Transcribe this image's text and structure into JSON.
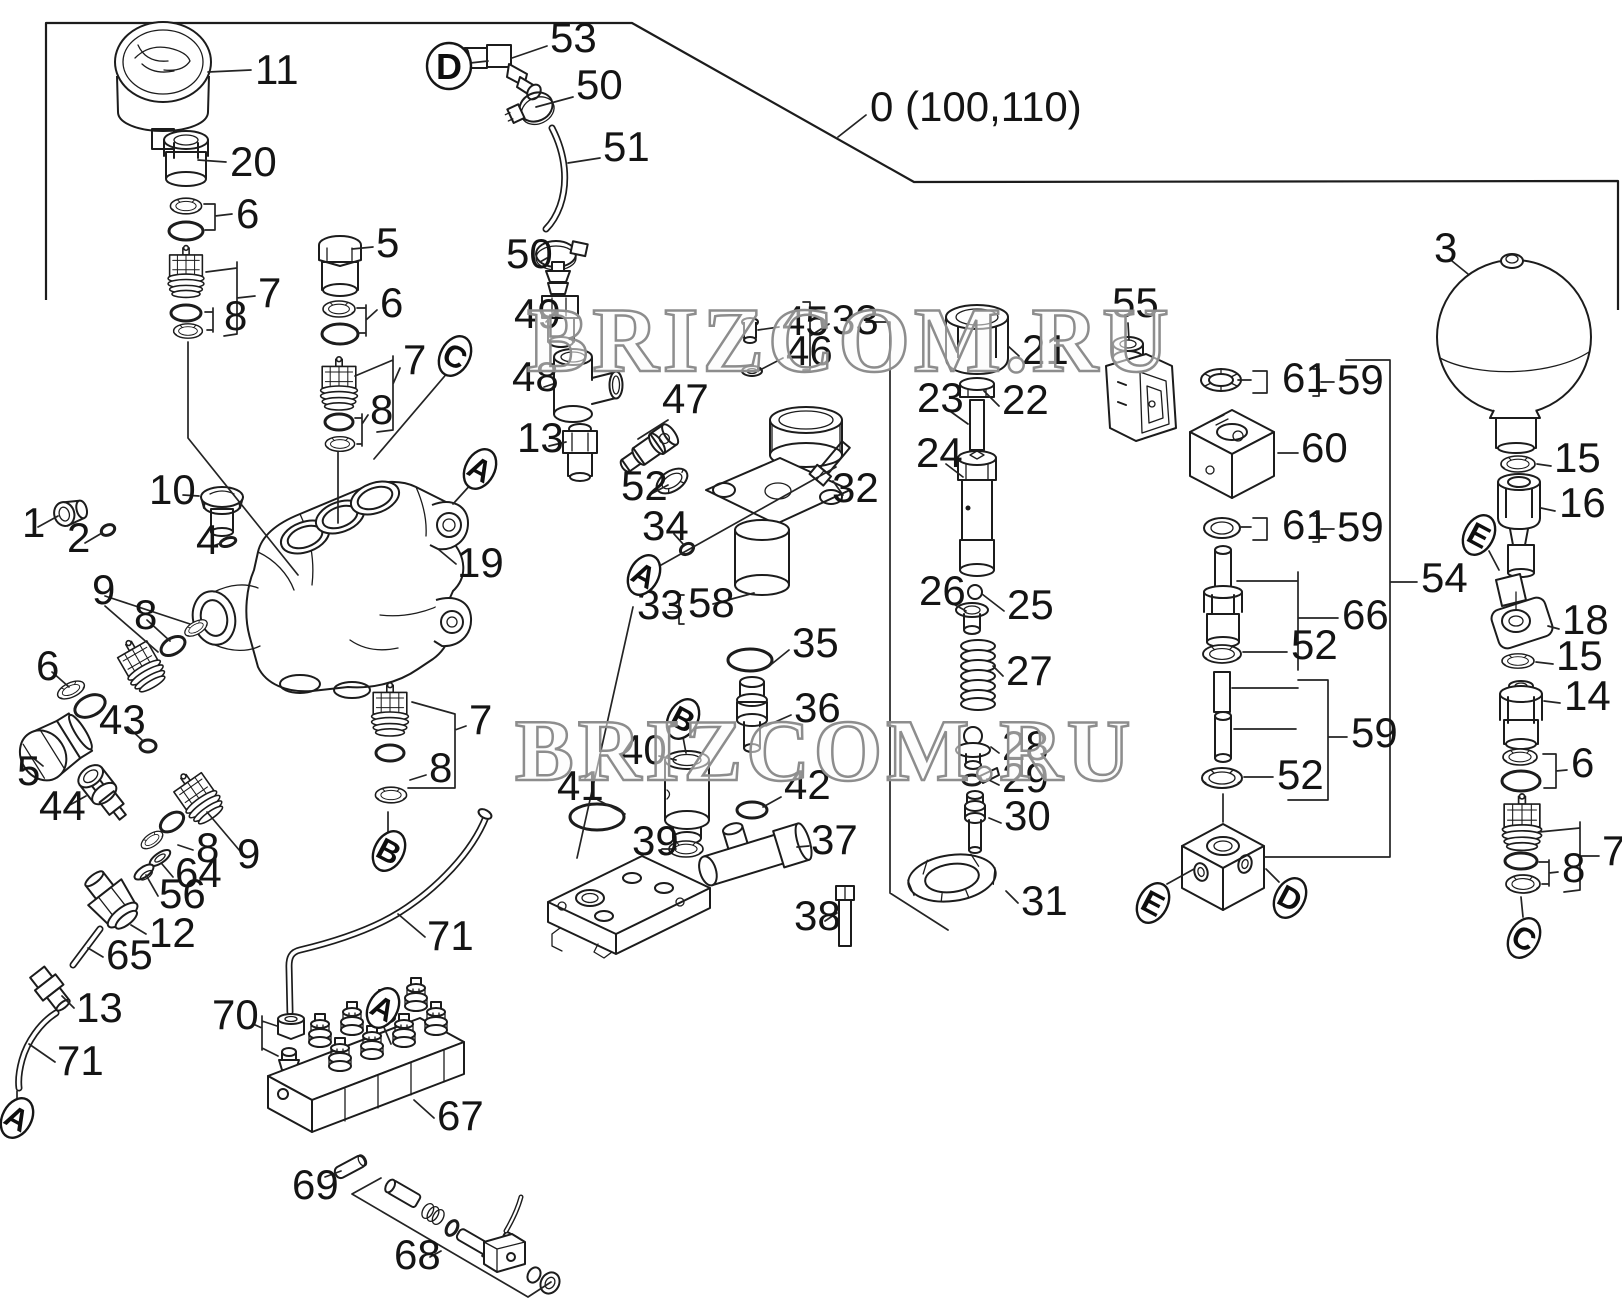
{
  "diagram": {
    "boundary_ref_label": "0 (100,110)",
    "watermark_text": "BRIZCOM.RU",
    "watermarks": [
      {
        "text": "BRIZCOM.RU",
        "x": 527,
        "y": 371,
        "size": 92
      },
      {
        "text": "BRIZCOM.RU",
        "x": 515,
        "y": 780,
        "size": 88
      }
    ],
    "colors": {
      "line": "#1c1c1c",
      "label": "#141414",
      "watermark_stroke": "#8d8d8d",
      "background": "#ffffff"
    },
    "labels": [
      {
        "t": "0 (100,110)",
        "x": 870,
        "y": 121
      },
      {
        "t": "11",
        "x": 255,
        "y": 84
      },
      {
        "t": "20",
        "x": 230,
        "y": 176
      },
      {
        "t": "6",
        "x": 236,
        "y": 228
      },
      {
        "t": "7",
        "x": 258,
        "y": 307
      },
      {
        "t": "8",
        "x": 224,
        "y": 330
      },
      {
        "t": "5",
        "x": 376,
        "y": 257
      },
      {
        "t": "6",
        "x": 380,
        "y": 317
      },
      {
        "t": "7",
        "x": 403,
        "y": 374
      },
      {
        "t": "8",
        "x": 370,
        "y": 424
      },
      {
        "t": "53",
        "x": 550,
        "y": 52
      },
      {
        "t": "50",
        "x": 576,
        "y": 99
      },
      {
        "t": "51",
        "x": 603,
        "y": 161
      },
      {
        "t": "50",
        "x": 506,
        "y": 268
      },
      {
        "t": "49",
        "x": 514,
        "y": 328
      },
      {
        "t": "48",
        "x": 512,
        "y": 391
      },
      {
        "t": "13",
        "x": 517,
        "y": 452
      },
      {
        "t": "47",
        "x": 662,
        "y": 413
      },
      {
        "t": "52",
        "x": 621,
        "y": 500
      },
      {
        "t": "34",
        "x": 642,
        "y": 540
      },
      {
        "t": "33",
        "x": 637,
        "y": 619
      },
      {
        "t": "58",
        "x": 688,
        "y": 617
      },
      {
        "t": "45",
        "x": 782,
        "y": 335
      },
      {
        "t": "46",
        "x": 786,
        "y": 365
      },
      {
        "t": "33",
        "x": 832,
        "y": 334
      },
      {
        "t": "21",
        "x": 1022,
        "y": 364
      },
      {
        "t": "22",
        "x": 1002,
        "y": 414
      },
      {
        "t": "23",
        "x": 917,
        "y": 412
      },
      {
        "t": "24",
        "x": 916,
        "y": 467
      },
      {
        "t": "25",
        "x": 1007,
        "y": 619
      },
      {
        "t": "26",
        "x": 919,
        "y": 605
      },
      {
        "t": "27",
        "x": 1006,
        "y": 685
      },
      {
        "t": "28",
        "x": 1002,
        "y": 760
      },
      {
        "t": "29",
        "x": 1002,
        "y": 792
      },
      {
        "t": "30",
        "x": 1004,
        "y": 830
      },
      {
        "t": "31",
        "x": 1021,
        "y": 915
      },
      {
        "t": "32",
        "x": 832,
        "y": 502
      },
      {
        "t": "35",
        "x": 792,
        "y": 657
      },
      {
        "t": "36",
        "x": 794,
        "y": 722
      },
      {
        "t": "40",
        "x": 620,
        "y": 764
      },
      {
        "t": "41",
        "x": 557,
        "y": 800
      },
      {
        "t": "39",
        "x": 632,
        "y": 855
      },
      {
        "t": "42",
        "x": 784,
        "y": 799
      },
      {
        "t": "37",
        "x": 811,
        "y": 854
      },
      {
        "t": "38",
        "x": 794,
        "y": 930
      },
      {
        "t": "3",
        "x": 1434,
        "y": 262
      },
      {
        "t": "55",
        "x": 1112,
        "y": 317
      },
      {
        "t": "61",
        "x": 1282,
        "y": 392
      },
      {
        "t": "59",
        "x": 1337,
        "y": 394
      },
      {
        "t": "60",
        "x": 1301,
        "y": 462
      },
      {
        "t": "61",
        "x": 1282,
        "y": 539
      },
      {
        "t": "59",
        "x": 1337,
        "y": 541
      },
      {
        "t": "66",
        "x": 1342,
        "y": 629
      },
      {
        "t": "52",
        "x": 1291,
        "y": 659
      },
      {
        "t": "59",
        "x": 1351,
        "y": 747
      },
      {
        "t": "52",
        "x": 1277,
        "y": 789
      },
      {
        "t": "54",
        "x": 1421,
        "y": 592
      },
      {
        "t": "15",
        "x": 1554,
        "y": 472
      },
      {
        "t": "16",
        "x": 1559,
        "y": 517
      },
      {
        "t": "18",
        "x": 1562,
        "y": 634
      },
      {
        "t": "15",
        "x": 1556,
        "y": 670
      },
      {
        "t": "14",
        "x": 1564,
        "y": 710
      },
      {
        "t": "6",
        "x": 1571,
        "y": 777
      },
      {
        "t": "7",
        "x": 1602,
        "y": 865
      },
      {
        "t": "8",
        "x": 1562,
        "y": 882
      },
      {
        "t": "1",
        "x": 22,
        "y": 537
      },
      {
        "t": "2",
        "x": 67,
        "y": 552
      },
      {
        "t": "10",
        "x": 149,
        "y": 504
      },
      {
        "t": "4",
        "x": 196,
        "y": 554
      },
      {
        "t": "9",
        "x": 92,
        "y": 604
      },
      {
        "t": "8",
        "x": 134,
        "y": 629
      },
      {
        "t": "6",
        "x": 36,
        "y": 680
      },
      {
        "t": "43",
        "x": 99,
        "y": 734
      },
      {
        "t": "5",
        "x": 17,
        "y": 785
      },
      {
        "t": "44",
        "x": 39,
        "y": 820
      },
      {
        "t": "19",
        "x": 457,
        "y": 577
      },
      {
        "t": "7",
        "x": 469,
        "y": 734
      },
      {
        "t": "8",
        "x": 429,
        "y": 782
      },
      {
        "t": "8",
        "x": 196,
        "y": 862
      },
      {
        "t": "9",
        "x": 237,
        "y": 868
      },
      {
        "t": "64",
        "x": 175,
        "y": 887
      },
      {
        "t": "56",
        "x": 159,
        "y": 908
      },
      {
        "t": "12",
        "x": 149,
        "y": 947
      },
      {
        "t": "65",
        "x": 106,
        "y": 969
      },
      {
        "t": "13",
        "x": 76,
        "y": 1022
      },
      {
        "t": "71",
        "x": 57,
        "y": 1075
      },
      {
        "t": "71",
        "x": 427,
        "y": 950
      },
      {
        "t": "70",
        "x": 212,
        "y": 1029
      },
      {
        "t": "67",
        "x": 437,
        "y": 1130
      },
      {
        "t": "69",
        "x": 292,
        "y": 1199
      },
      {
        "t": "68",
        "x": 394,
        "y": 1269
      }
    ],
    "callouts": [
      {
        "t": "D",
        "x": 449,
        "y": 66,
        "shape": "circle"
      },
      {
        "t": "C",
        "x": 455,
        "y": 356,
        "shape": "oval"
      },
      {
        "t": "A",
        "x": 480,
        "y": 469,
        "shape": "oval"
      },
      {
        "t": "A",
        "x": 644,
        "y": 575,
        "shape": "oval"
      },
      {
        "t": "B",
        "x": 683,
        "y": 719,
        "shape": "oval"
      },
      {
        "t": "B",
        "x": 389,
        "y": 851,
        "shape": "oval"
      },
      {
        "t": "A",
        "x": 383,
        "y": 1008,
        "shape": "oval"
      },
      {
        "t": "A",
        "x": 17,
        "y": 1118,
        "shape": "oval"
      },
      {
        "t": "E",
        "x": 1479,
        "y": 535,
        "shape": "oval"
      },
      {
        "t": "E",
        "x": 1153,
        "y": 903,
        "shape": "oval"
      },
      {
        "t": "D",
        "x": 1290,
        "y": 898,
        "shape": "oval"
      },
      {
        "t": "C",
        "x": 1524,
        "y": 938,
        "shape": "oval"
      }
    ]
  }
}
